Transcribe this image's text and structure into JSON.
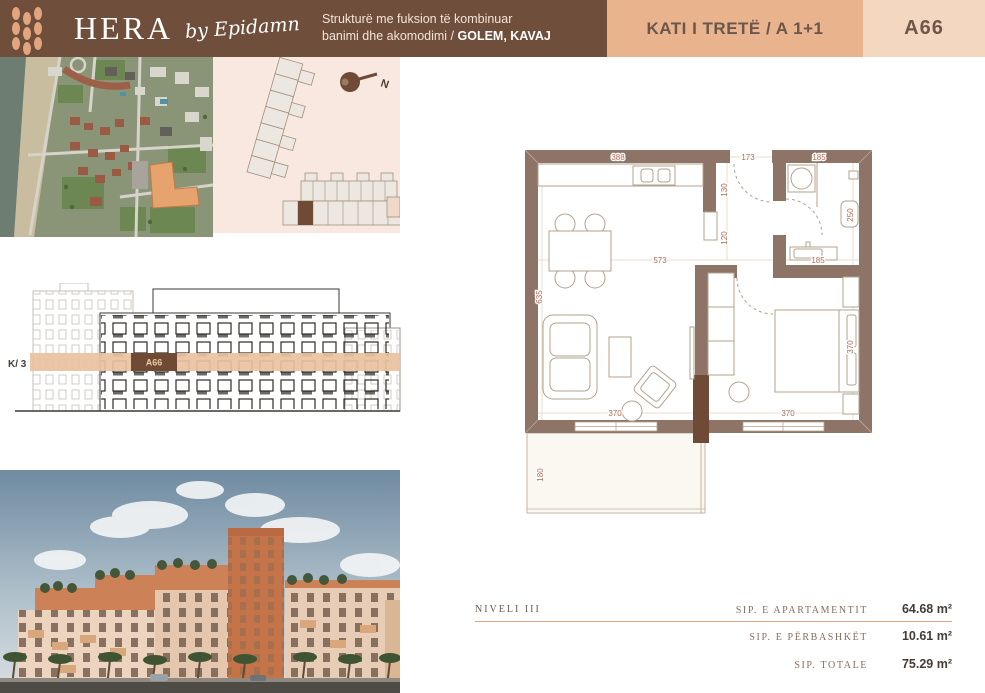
{
  "header": {
    "logo": {
      "name": "HERA",
      "byline": "by Epidamn"
    },
    "subtitle_line1": "Strukturë me fuksion të kombinuar",
    "subtitle_line2": "banimi dhe akomodimi",
    "location_sep": "/ ",
    "location": "GOLEM, KAVAJ",
    "floor_label": "KATI I TRETË / A 1+1",
    "unit_code": "A66"
  },
  "site_plan": {
    "north_label": "N"
  },
  "elevation": {
    "level_label": "K/ 3",
    "unit_code": "A66"
  },
  "floor_plan": {
    "dims": {
      "kitchen_width": "388",
      "entry_width": "173",
      "bath_width": "185",
      "hall_upper": "130",
      "hall_lower": "120",
      "living_width": "573",
      "vanity_width": "185",
      "living_depth": "635",
      "bath_depth": "250",
      "bedroom_depth": "370",
      "living_window": "370",
      "bedroom_window": "370",
      "balcony_depth": "180"
    }
  },
  "summary": {
    "level_label": "NIVELI III",
    "rows": [
      {
        "label": "SIP. E APARTAMENTIT",
        "value": "64.68 m²"
      },
      {
        "label": "SIP. E PËRBASHKËT",
        "value": "10.61 m²"
      },
      {
        "label": "SIP. TOTALE",
        "value": "75.29 m²"
      }
    ]
  },
  "colors": {
    "header_brown": "#6f4e3b",
    "tan": "#e9b38e",
    "light_peach": "#f4d7c1",
    "accent_rust": "#b06a50",
    "wall": "#8d7466",
    "wall_dark": "#6e4a37",
    "band": "#e9c2a0",
    "panel_pink": "#f8e8e0",
    "rule": "#e0a57f"
  }
}
